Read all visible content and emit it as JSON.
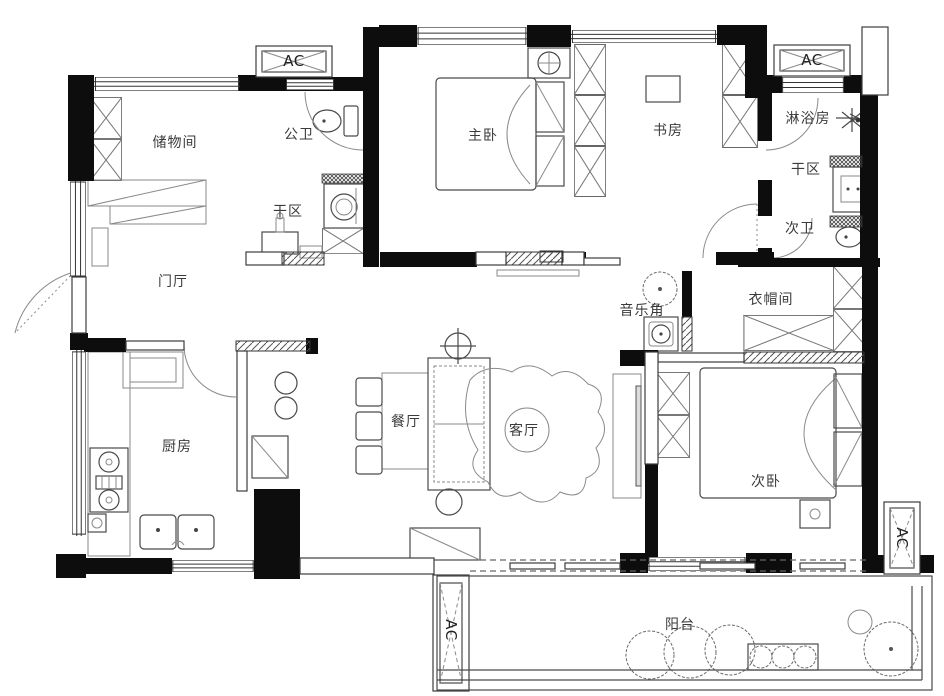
{
  "plan": {
    "type": "apartment-floor-plan",
    "rooms": [
      {
        "id": "storage-room",
        "label": "储物间"
      },
      {
        "id": "public-bath",
        "label": "公卫"
      },
      {
        "id": "dry-area-left",
        "label": "干区"
      },
      {
        "id": "entry-hall",
        "label": "门厅"
      },
      {
        "id": "master-bedroom",
        "label": "主卧"
      },
      {
        "id": "study",
        "label": "书房"
      },
      {
        "id": "shower-room",
        "label": "淋浴房"
      },
      {
        "id": "dry-area-right",
        "label": "干区"
      },
      {
        "id": "second-bath",
        "label": "次卫"
      },
      {
        "id": "music-corner",
        "label": "音乐角"
      },
      {
        "id": "cloakroom",
        "label": "衣帽间"
      },
      {
        "id": "kitchen",
        "label": "厨房"
      },
      {
        "id": "dining-room",
        "label": "餐厅"
      },
      {
        "id": "living-room",
        "label": "客厅"
      },
      {
        "id": "second-bedroom",
        "label": "次卧"
      },
      {
        "id": "balcony",
        "label": "阳台"
      }
    ],
    "ac_units": [
      {
        "id": "ac-top-left",
        "label": "AC"
      },
      {
        "id": "ac-top-right",
        "label": "AC"
      },
      {
        "id": "ac-bottom-center",
        "label": "AC"
      },
      {
        "id": "ac-right",
        "label": "AC"
      }
    ],
    "colors": {
      "wall": "#0d0d0d",
      "line": "#4a4a4a",
      "paper": "#ffffff"
    }
  }
}
